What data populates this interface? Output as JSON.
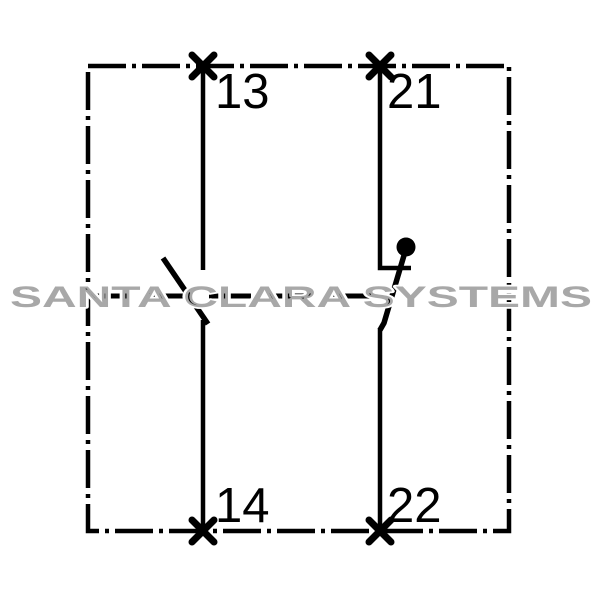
{
  "watermark": {
    "text": "SANTA CLARA SYSTEMS",
    "color": "#a8a8a8"
  },
  "schematic": {
    "kind": "auxiliary-contact-block-wiring-diagram",
    "terminals": {
      "top_left": "13",
      "top_right": "21",
      "bottom_left": "14",
      "bottom_right": "22"
    },
    "contacts": [
      {
        "symbol": "normally-open-contact",
        "terminal_top": "13",
        "terminal_bottom": "14"
      },
      {
        "symbol": "normally-closed-contact",
        "terminal_top": "21",
        "terminal_bottom": "22"
      }
    ],
    "colors": {
      "line": "#000000",
      "background": "#ffffff"
    }
  }
}
